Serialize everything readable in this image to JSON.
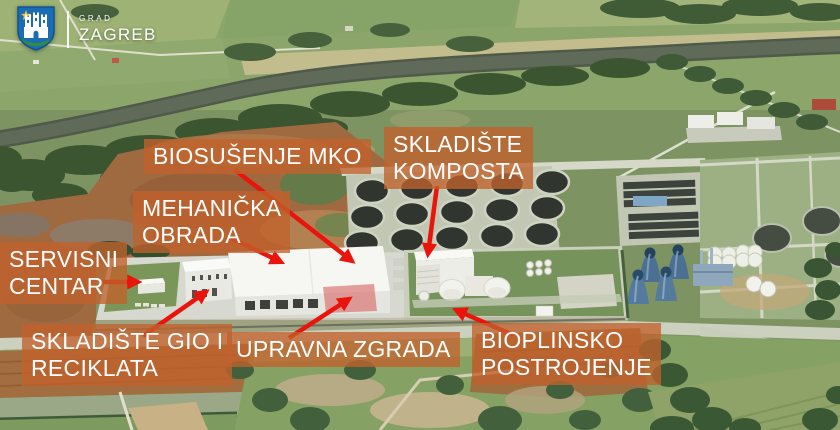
{
  "branding": {
    "org_prefix": "GRAD",
    "org_name": "ZAGREB"
  },
  "annotations": {
    "labels": [
      {
        "id": "biosusenje-mko",
        "lines": [
          "BIOSUŠENJE MKO"
        ]
      },
      {
        "id": "mehanicka-obrada",
        "lines": [
          "MEHANIČKA",
          "OBRADA"
        ]
      },
      {
        "id": "skladiste-komposta",
        "lines": [
          "SKLADIŠTE",
          "KOMPOSTA"
        ]
      },
      {
        "id": "servisni-centar",
        "lines": [
          "SERVISNI",
          "CENTAR"
        ]
      },
      {
        "id": "skladiste-gio-i-reciklata",
        "lines": [
          "SKLADIŠTE GIO I",
          "RECIKLATA"
        ]
      },
      {
        "id": "upravna-zgrada",
        "lines": [
          "UPRAVNA ZGRADA"
        ]
      },
      {
        "id": "bioplinsko-postrojenje",
        "lines": [
          "BIOPLINSKO",
          "POSTROJENJE"
        ]
      }
    ]
  },
  "colors": {
    "label_bg": "#c2622b",
    "label_text": "#ffffff",
    "arrow_red": "#e9150d",
    "logo_blue": "#1a6db4"
  },
  "icons": {
    "logo": "zagreb-coat-of-arms"
  }
}
